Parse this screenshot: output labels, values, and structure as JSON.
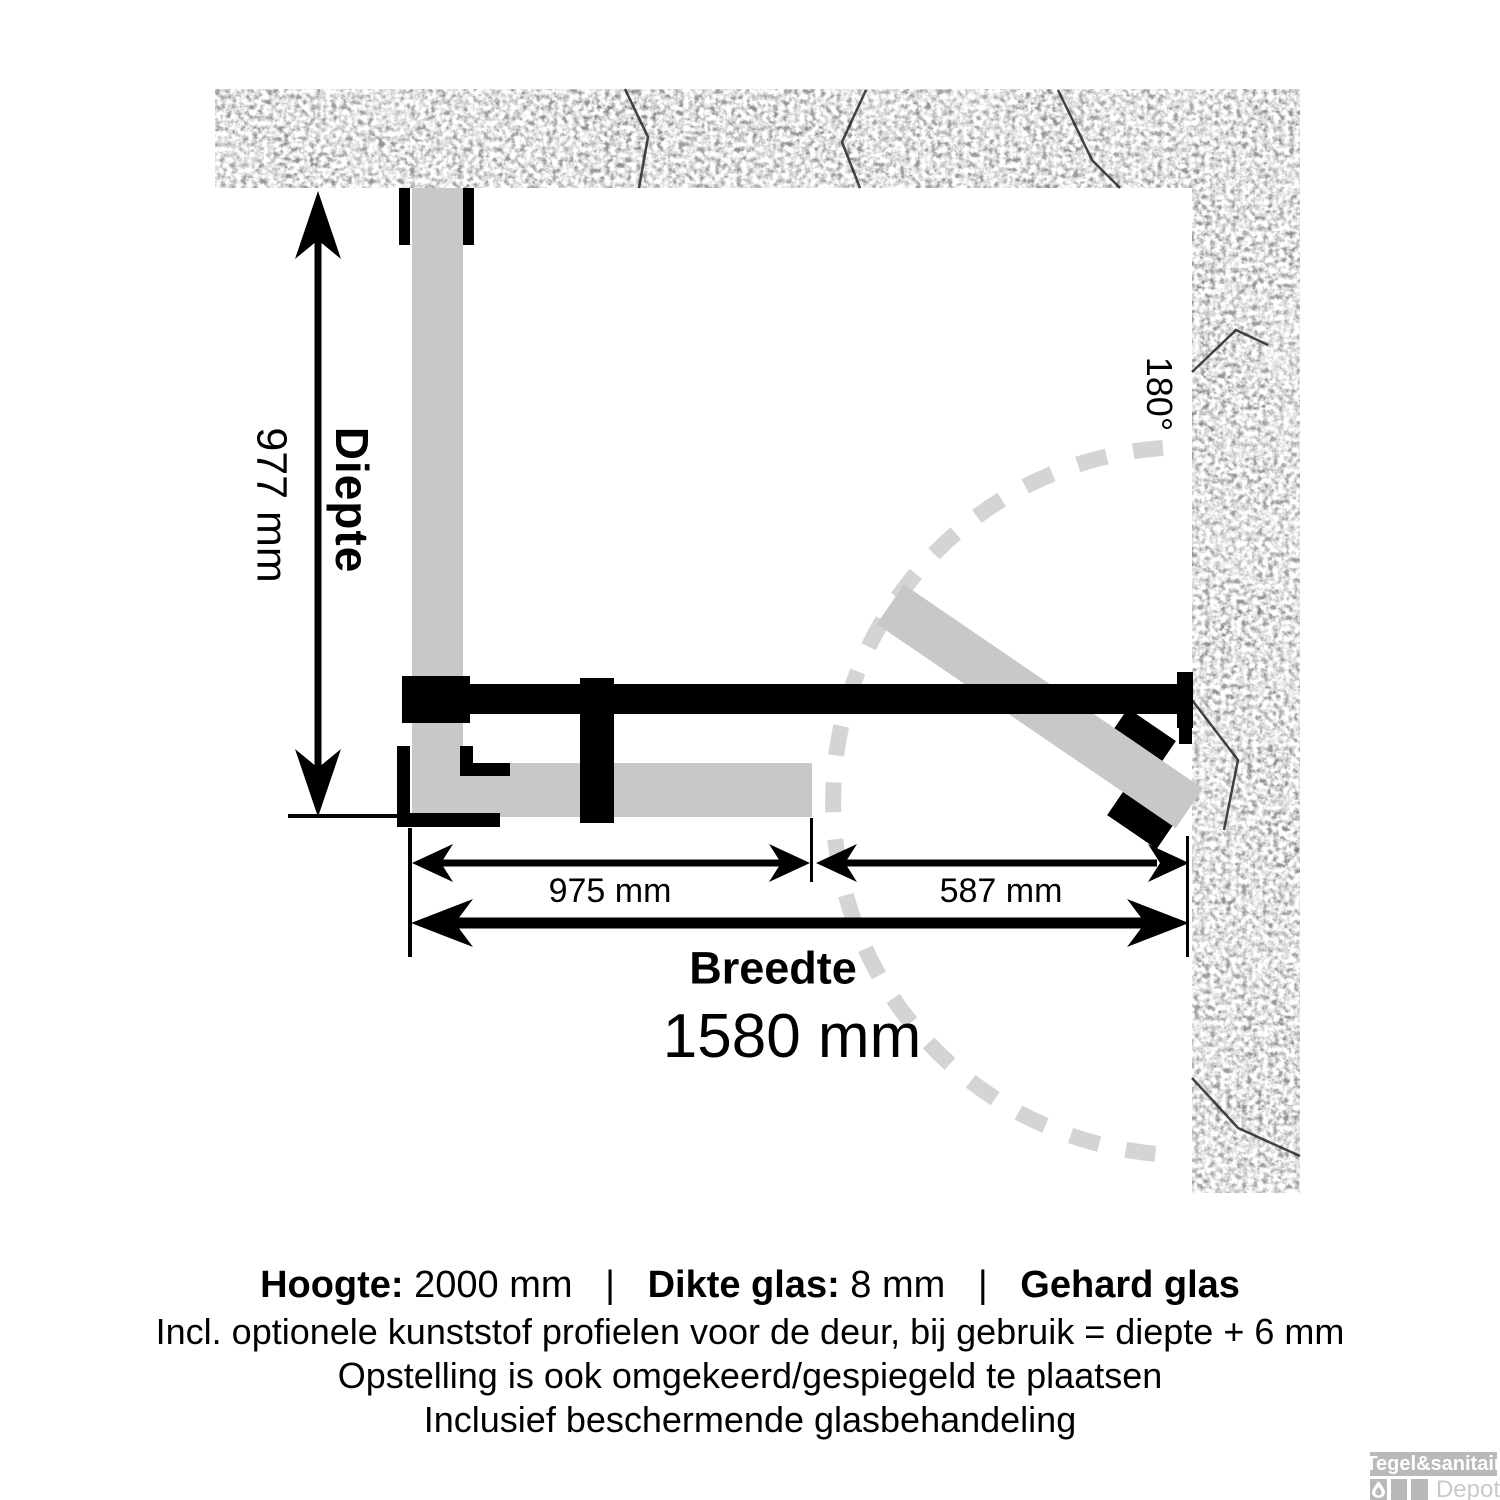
{
  "diagram": {
    "depth_label": "Diepte",
    "depth_value": "977 mm",
    "swing_angle": "180°",
    "fixed_panel_width": "975 mm",
    "door_width": "587 mm",
    "width_label": "Breedte",
    "width_value": "1580 mm"
  },
  "specs": {
    "hoogte_label": "Hoogte:",
    "hoogte_value": "2000 mm",
    "separator": "|",
    "dikte_label": "Dikte glas:",
    "dikte_value": "8 mm",
    "gehard_label": "Gehard glas",
    "note1": "Incl. optionele kunststof profielen voor de deur, bij gebruik = diepte + 6 mm",
    "note2": "Opstelling is ook omgekeerd/gespiegeld te plaatsen",
    "note3": "Inclusief beschermende glasbehandeling"
  },
  "watermark": {
    "brand": "Tegel&sanitair",
    "sub": "Depot"
  },
  "colors": {
    "background": "#ffffff",
    "glass": "#c8c8c8",
    "swing_arc": "#d4d4d4",
    "hardware": "#000000",
    "wall_base": "#4a4a4a",
    "watermark_gray": "#b9b9b9"
  }
}
